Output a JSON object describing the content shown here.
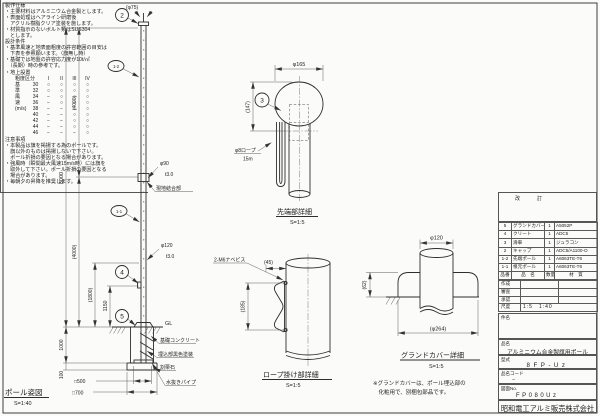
{
  "sheet": {
    "notes_production": {
      "title": "製作仕様",
      "lines": [
        "・主要材料はアルミニウム合金製とします。",
        "・表面処理はヘアライン研磨後",
        "　アクリル樹脂クリア塗装を施します。",
        "・材質指示のないボルト類はSUS304",
        "　とします。"
      ]
    },
    "notes_design": {
      "title": "設計条件",
      "lines": [
        "・基準風速と地表面粗度の許容範囲の目安は",
        "　下表を参照願います。（旗無し時）",
        "・基礎では地盤の許容応力度が10t/㎡",
        "　（長期）時の参考です。",
        "・地上設置"
      ]
    },
    "wind_table": {
      "corner": "粗度区分",
      "columns": [
        "I",
        "II",
        "III",
        "IV"
      ],
      "side": [
        "基",
        "準",
        "風",
        "速",
        "(m/s)",
        "",
        "",
        "",
        ""
      ],
      "rows": [
        [
          "30",
          "○",
          "○",
          "○",
          "○"
        ],
        [
          "32",
          "○",
          "○",
          "○",
          "○"
        ],
        [
          "34",
          "−",
          "○",
          "○",
          "○"
        ],
        [
          "36",
          "−",
          "○",
          "○",
          "○"
        ],
        [
          "38",
          "−",
          "−",
          "○",
          "○"
        ],
        [
          "40",
          "−",
          "−",
          "○",
          "○"
        ],
        [
          "42",
          "−",
          "−",
          "○",
          "○"
        ],
        [
          "44",
          "−",
          "−",
          "○",
          "○"
        ],
        [
          "46",
          "−",
          "−",
          "−",
          "○"
        ]
      ]
    },
    "notes_caution": {
      "title": "注意事項",
      "lines": [
        "・本製品は旗を掲揚する為のポールです。",
        "　旗以外のものは掲揚しないで下さい。",
        "　ポール折損の要因となる場合があります。",
        "・強風時（瞬間最大風速15m/s時）には旗を",
        "　取外して下さい。ポール折損の要因となる",
        "　場合があります。",
        "・毎朝夕の昇降を推奨します。"
      ]
    },
    "revision_label": "改　訂",
    "bom": {
      "headers": [
        "品番",
        "品　名",
        "数量",
        "材　質"
      ],
      "rows": [
        [
          "5",
          "グランドカバー",
          "1",
          "A5052P"
        ],
        [
          "4",
          "クリート",
          "1",
          "ADC5"
        ],
        [
          "3",
          "滑車",
          "1",
          "ジュラコン"
        ],
        [
          "2",
          "キャップ",
          "1",
          "ADC5/A1100-O"
        ],
        [
          "1-2",
          "先端ポール",
          "1",
          "A6063TE-T6"
        ],
        [
          "1-1",
          "根元ポール",
          "1",
          "A6063TE-T6"
        ]
      ]
    },
    "signoff": {
      "rows": [
        "作成",
        "審査",
        "承認"
      ],
      "scale_label": "尺度",
      "scale_value": "1:5　1:40"
    },
    "subject_label": "件名",
    "product": {
      "label": "品名",
      "value": "アルミニウム合金製旗用ポール"
    },
    "model": {
      "label": "型式",
      "value": "8FP-Uz"
    },
    "code": {
      "label": "品名コード",
      "value": "−"
    },
    "drawing_no": {
      "label": "図面No.",
      "value": "FP080Uz"
    },
    "company": "昭和電工アルミ販売株式会社"
  },
  "elevation": {
    "title": "ポール姿図",
    "scale": "S=1:40",
    "cap_dia": "(φ75)",
    "dim_total": "8000",
    "dim_upper": "(4000)",
    "dim_lower": "(4000)",
    "dim_1800": "(1800)",
    "dim_1150": "1150",
    "dim_1000": "1000",
    "dim_100": "100",
    "dim_sq500": "□500",
    "dim_sq700": "□700",
    "joint_dia": "φ90",
    "joint_thk": "t3.0",
    "joint_label": "現地結合部",
    "lower_dia": "φ120",
    "lower_thk": "t3.0",
    "gl": "GL",
    "ann_concrete": "基礎コンクリート",
    "ann_paint": "埋込部黒色塗装",
    "ann_gravel": "割栗石",
    "ann_drain": "水抜きパイプ",
    "balloon_cap": "2",
    "balloon_tip_pole": "1-2",
    "balloon_base_pole": "1-1",
    "balloon_cleat": "4",
    "balloon_cover": "5"
  },
  "tip_detail": {
    "title": "先端部詳細",
    "scale": "S=1:5",
    "dim_dia": "φ165",
    "dim_h": "(147)",
    "balloon_pulley": "3",
    "rope_line1": "φ8ロープ",
    "rope_line2": "15m"
  },
  "rope_detail": {
    "title": "ロープ掛け部詳細",
    "scale": "S=1:5",
    "screw": "2-M6ナベビス",
    "dim_w": "(45)",
    "dim_h": "(185)"
  },
  "cover_detail": {
    "title": "グランドカバー詳細",
    "scale": "S=1:5",
    "dim_dia": "φ120",
    "dim_h": "(62)",
    "dim_od": "(φ264)",
    "note1": "※グランドカバーは、ポール埋込部の",
    "note2": "　化粧用で、別梱包部品です。"
  }
}
